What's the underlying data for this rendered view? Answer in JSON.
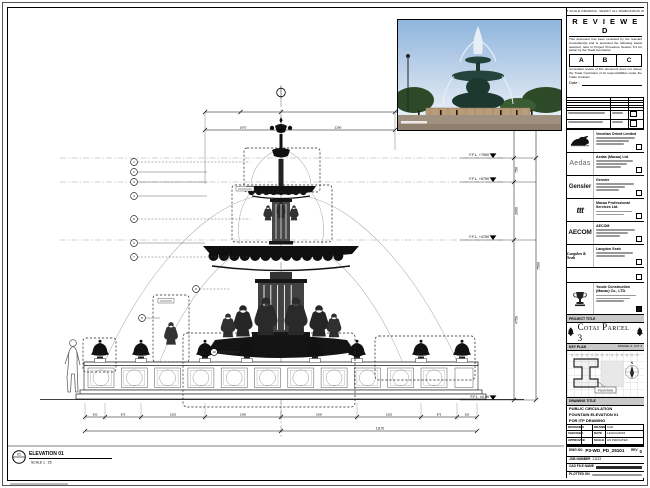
{
  "sheet": {
    "disclaimer": "DO NOT SCALE DRAWING. VERIFY ALL DIMENSIONS ON SITE."
  },
  "stamp": {
    "title": "R E V I E W E D",
    "body1": "This document has been reviewed by the relevant Consultant(s) and is accorded the following status selected, refer to Project Procedure Section 5.4 for action by the Trade Contractor.",
    "options": [
      "A",
      "B",
      "C"
    ],
    "body2": "Consultant review of this document does not relieve the Trade Contractor of its responsibilities under the Trade Contract.",
    "date_label": "Date :"
  },
  "consultants": [
    {
      "name": "Venetian Orient Limited"
    },
    {
      "logo": "Aedas",
      "name": "Aedas (Macau) Ltd."
    },
    {
      "logo": "Gensler",
      "name": "Gensler"
    },
    {
      "logo": "ttt",
      "name": "Macau Professional Services Ltd."
    },
    {
      "logo": "AECOM",
      "name": "AECOM"
    },
    {
      "logo": "Langdon & Seah",
      "name": "Langdon Seah"
    }
  ],
  "contractor": {
    "name": "Youde Construction (Macau) Co., LTD."
  },
  "project": {
    "band": "PROJECT TITLE",
    "title": "Cotai Parcel 3"
  },
  "keyplan": {
    "band": "KEY PLAN",
    "parcel": "PARCEL 3, LOT 3",
    "location": "FOUNTAIN",
    "north": "N"
  },
  "titleblock": {
    "band": "DRAWING TITLE",
    "title_lines": [
      "PUBLIC CIRCULATION",
      "FOUNTAIN ELEVATION 01",
      "FOR ITP DRAWING"
    ],
    "grid": {
      "designed_label": "DESIGNED",
      "designed": "-",
      "drawn_label": "DRAWN",
      "drawn": "CAD",
      "checked_label": "CHECKED",
      "checked": "-",
      "date_label": "DATE",
      "date": "12/AUG/2015",
      "approved_label": "APPROVED",
      "approved": "-",
      "scale_label": "SCALE",
      "scale": "AS INDICATED"
    },
    "dwg_label": "DWG NO.",
    "dwg_no": "P3-WD_PD_25101",
    "rev_label": "REV",
    "rev": "0",
    "job_label": "JOB NUMBER",
    "job_no": "21123",
    "cad_label": "CAD FILE NAME",
    "plot_label": "PLOTTED ON"
  },
  "drawing": {
    "view_no": "01",
    "view_title": "ELEVATION 01",
    "view_scale": "SCALE  1 : 25",
    "levels": [
      "F.F.L. +7500",
      "F.F.L. +6750",
      "F.F.L. +4750",
      "F.F.L. ±0.00"
    ],
    "vdims": [
      "750",
      "2000",
      "4750"
    ],
    "vdim_overall": "7500",
    "top_dims": [
      "1670",
      "2290"
    ],
    "bottom_dims": [
      "500",
      "875",
      "1625",
      "1900",
      "1900",
      "1625",
      "875",
      "500"
    ],
    "bottom_overall": "11170",
    "keynotes": [
      "1",
      "2",
      "3",
      "4",
      "5",
      "6",
      "7",
      "8",
      "9",
      "10"
    ]
  },
  "photo": {
    "sky_top": "#8fb4dd",
    "sky_bottom": "#e6edf4",
    "foliage": "#2d4a28",
    "bronze": "#24433a",
    "stone": "#b99d78",
    "spray": "#e8eef5"
  }
}
